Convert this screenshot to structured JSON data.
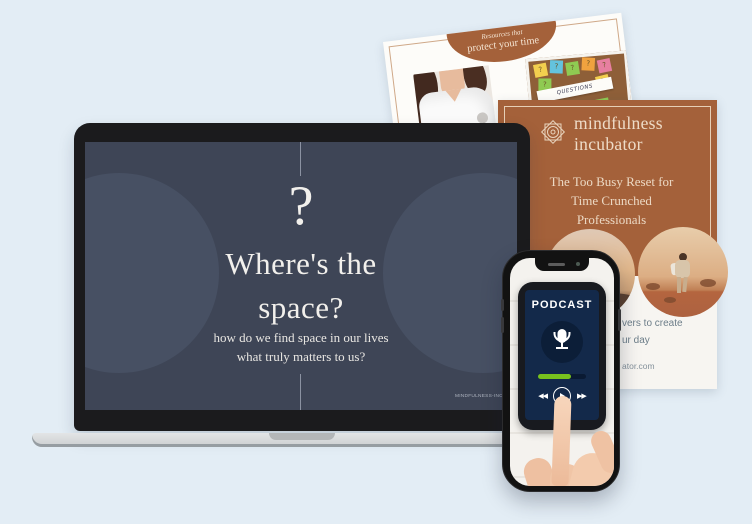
{
  "colors": {
    "background": "#e3edf5",
    "slide_navy": "#3e4556",
    "slide_circle": "#475063",
    "brand_brown": "#a4613a",
    "cream_text": "#ecd9c4",
    "progress_green": "#78c21e",
    "podcast_screen_navy": "#13294a"
  },
  "laptop": {
    "slide": {
      "question_mark": "?",
      "title_line1": "Where's the",
      "title_line2": "space?",
      "subtitle_line1": "how do we find space in our lives",
      "subtitle_line2": "what truly matters to us?",
      "footer_url": "MINDFULNESS-INCU"
    }
  },
  "resources_page": {
    "badge_line1": "Resources that",
    "badge_line2": "protect your time",
    "corkboard_label": "QUESTIONS",
    "note_glyph": "?"
  },
  "workbook_page": {
    "brand_line1": "mindfulness",
    "brand_line2": "incubator",
    "title_line1": "The Too Busy Reset for",
    "title_line2": "Time Crunched",
    "title_line3": "Professionals",
    "footer_fragment_line1": "vers to create",
    "footer_fragment_line2": "ur day",
    "footer_fragment_url": "ator.com"
  },
  "phone": {
    "app_title": "PODCAST",
    "rewind_glyph": "◀◀",
    "play_glyph": "",
    "forward_glyph": "▶▶"
  }
}
